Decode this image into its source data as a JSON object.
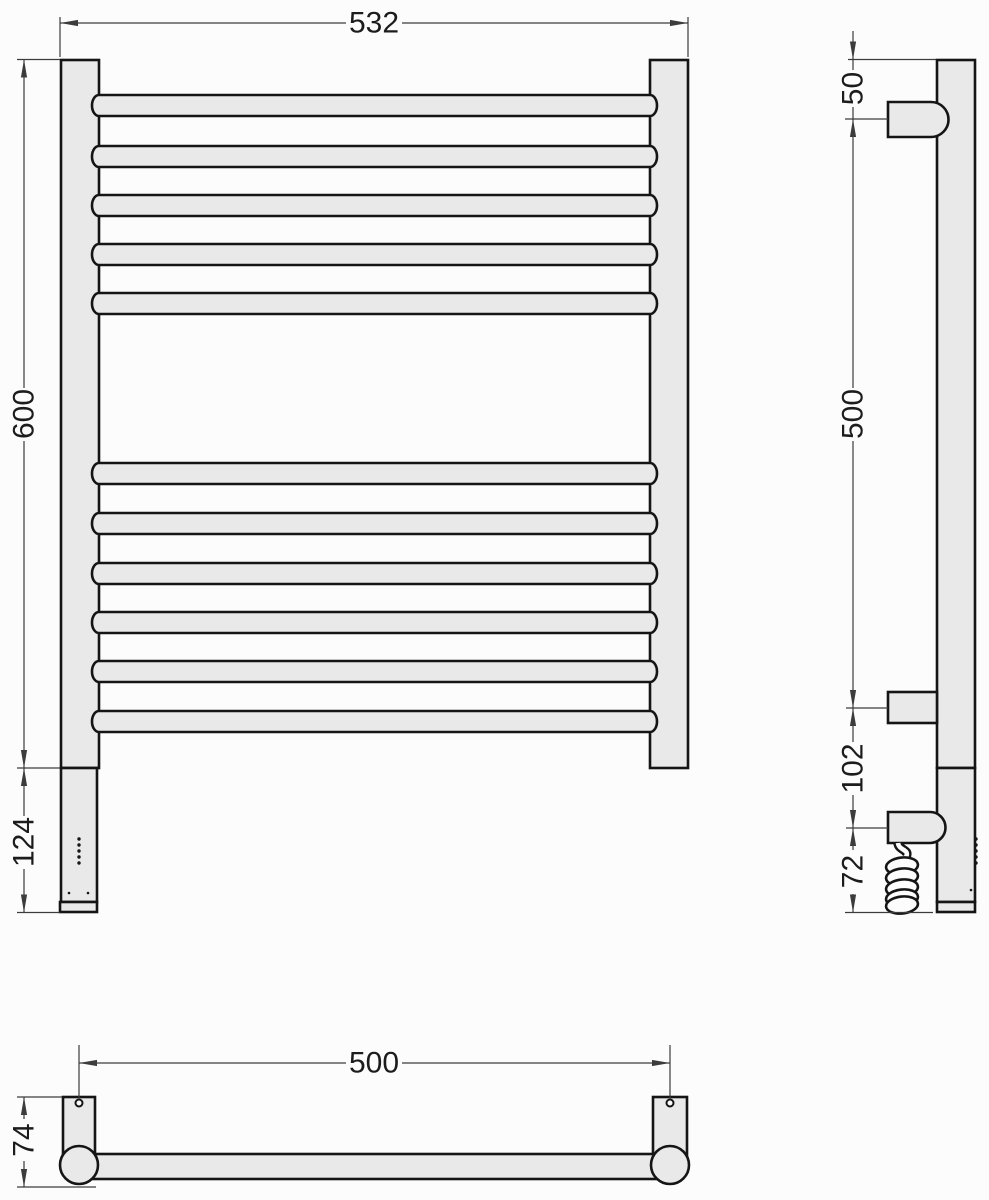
{
  "dimensions": {
    "front": {
      "overall_width": "532",
      "rail_height": "600",
      "heater_section_height": "124"
    },
    "side": {
      "top_to_upper_bracket": "50",
      "bracket_to_bracket": "500",
      "bracket_to_outlet": "102",
      "outlet_to_bottom": "72"
    },
    "plan": {
      "mount_spacing": "500",
      "depth": "74"
    }
  },
  "colors": {
    "metal_fill": "#e9e9e9",
    "outline": "#151515",
    "dimension_line": "#3c3c3c",
    "label_text": "#1c1c1c",
    "background": "#fcfcfc"
  }
}
